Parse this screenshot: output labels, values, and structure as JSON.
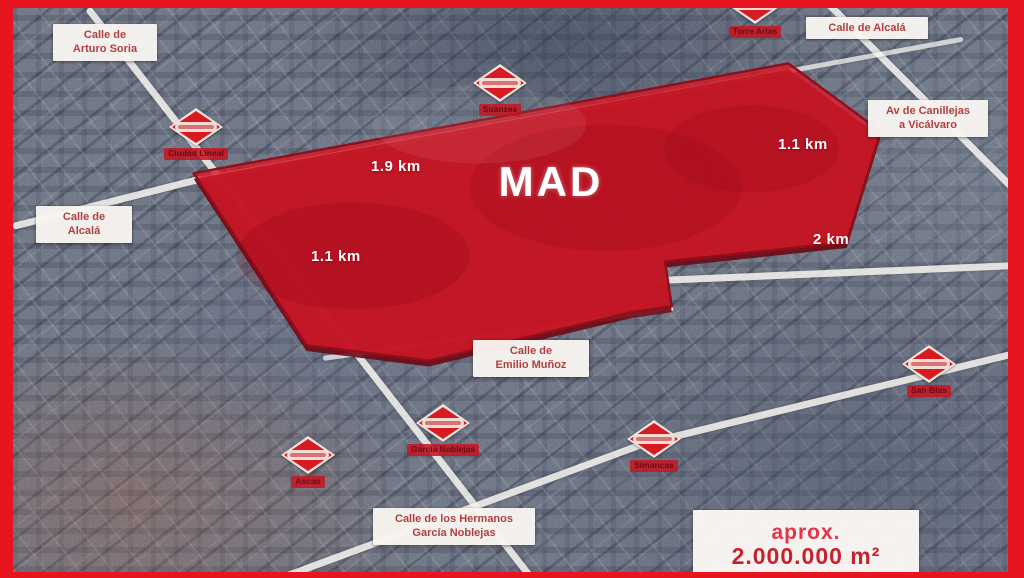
{
  "map": {
    "region": {
      "label": "MAD",
      "area_line1": "aprox.",
      "area_line2": "2.000.000 m²"
    },
    "distances": [
      {
        "position": "top-center",
        "text": "1.9 km"
      },
      {
        "position": "upper-right",
        "text": "1.1 km"
      },
      {
        "position": "lower-left",
        "text": "1.1 km"
      },
      {
        "position": "lower-right",
        "text": "2 km"
      }
    ],
    "streets": [
      {
        "id": "arturo-soria",
        "line1": "Calle de",
        "line2": "Arturo Soria"
      },
      {
        "id": "alcala-top-right",
        "line1": "Calle de Alcalá",
        "line2": ""
      },
      {
        "id": "canillejas-vicalvaro",
        "line1": "Av de Canillejas",
        "line2": "a Vicálvaro"
      },
      {
        "id": "alcala-left",
        "line1": "Calle de",
        "line2": "Alcalá"
      },
      {
        "id": "emilio-munoz",
        "line1": "Calle de",
        "line2": "Emilio Muñoz"
      },
      {
        "id": "hermanos-garcia-noblejas",
        "line1": "Calle de los Hermanos",
        "line2": "García Noblejas"
      }
    ],
    "metro_stations": [
      {
        "id": "ciudad-lineal",
        "name": "Ciudad Lineal"
      },
      {
        "id": "suanzes",
        "name": "Suanzes"
      },
      {
        "id": "torre-arias",
        "name": "Torre Arias"
      },
      {
        "id": "ascao",
        "name": "Ascao"
      },
      {
        "id": "garcia-noblejas",
        "name": "García Noblejas"
      },
      {
        "id": "simancas",
        "name": "Simancas"
      },
      {
        "id": "san-blas",
        "name": "San Blas"
      }
    ],
    "colors": {
      "frame": "#e81420",
      "region_fill": "#d7192b",
      "metro_red": "#d61c22",
      "street_label_text": "#b04040",
      "area_text": "#c9202e"
    }
  }
}
